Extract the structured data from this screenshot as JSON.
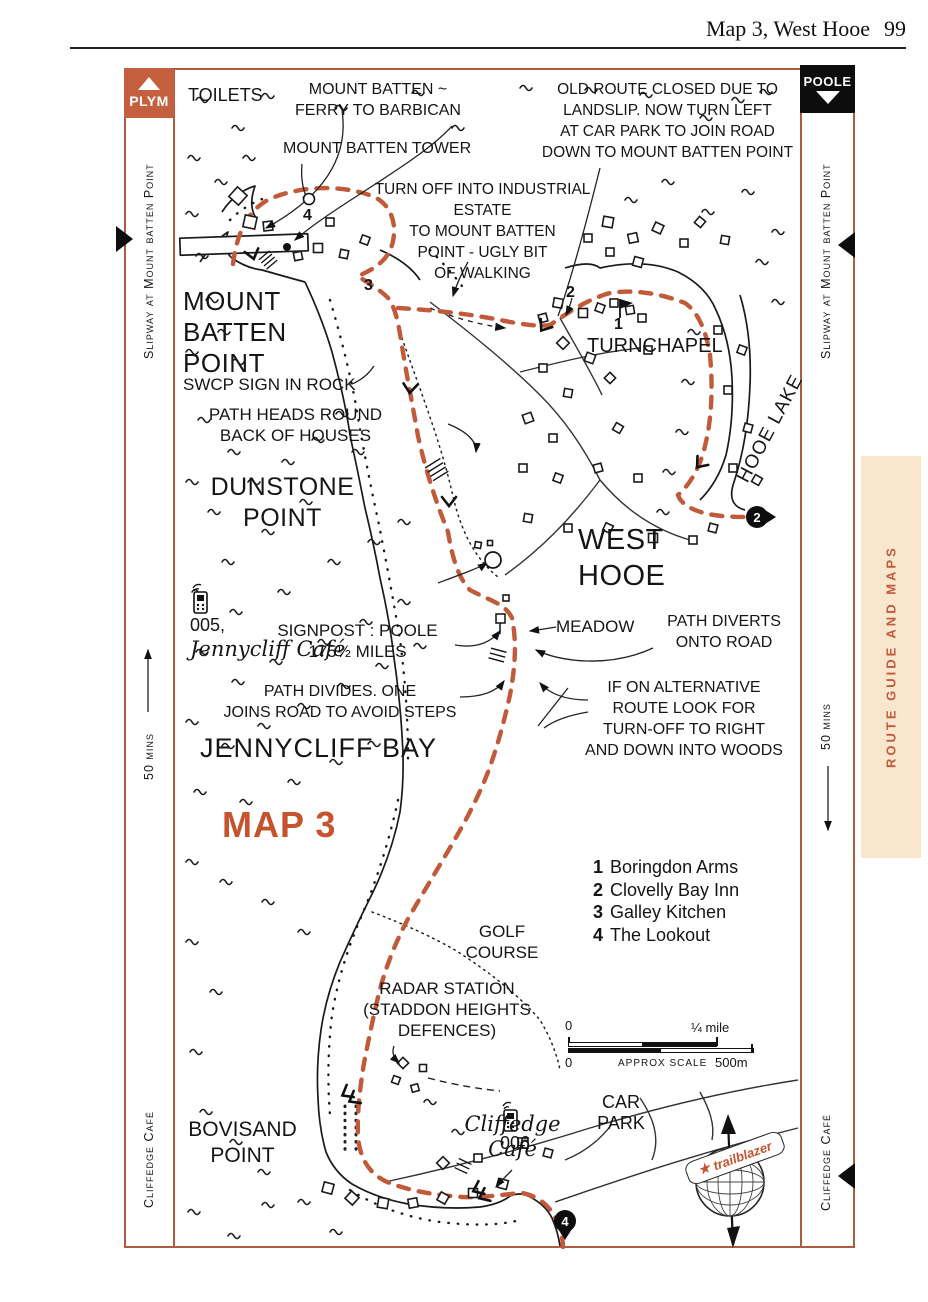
{
  "page": {
    "header_title": "Map 3, West Hooe",
    "page_number": "99"
  },
  "corner_tabs": {
    "plym": "PLYM",
    "poole": "POOLE"
  },
  "margins": {
    "left": {
      "top_label": "Slipway at Mount batten Point",
      "mid_label": "50 mins",
      "bottom_label": "Cliffedge Café"
    },
    "right": {
      "top_label": "Slipway at Mount batten Point",
      "mid_label": "50 mins",
      "bottom_label": "Cliffedge Café",
      "tab_label": "ROUTE GUIDE AND MAPS"
    }
  },
  "map": {
    "title": "MAP 3",
    "labels": {
      "toilets": "TOILETS",
      "ferry": "MOUNT BATTEN ~\nFERRY TO BARBICAN",
      "tower": "MOUNT BATTEN TOWER",
      "old_route": "OLD ROUTE CLOSED DUE TO\nLANDSLIP. NOW TURN LEFT\nAT CAR PARK TO JOIN ROAD\nDOWN TO MOUNT BATTEN POINT",
      "turn_off": "TURN OFF INTO INDUSTRIAL ESTATE\nTO MOUNT BATTEN\nPOINT - UGLY BIT\nOF WALKING",
      "mount_batten_point": "MOUNT\nBATTEN\nPOINT",
      "swcp": "SWCP SIGN IN ROCK",
      "path_heads": "PATH HEADS ROUND\nBACK OF HOUSES",
      "turnchapel": "TURNCHAPEL",
      "hooe_lake": "HOOE LAKE",
      "dunstone": "DUNSTONE\nPOINT",
      "jennycliff_cafe_num": "005,",
      "jennycliff_cafe_name": "Jennycliff Café",
      "west_hooe": "WEST\nHOOE",
      "signpost": "SIGNPOST : POOLE\n175½ MILES",
      "meadow": "MEADOW",
      "path_diverts": "PATH DIVERTS\nONTO ROAD",
      "path_divides": "PATH DIVIDES. ONE\nJOINS ROAD TO AVOID STEPS",
      "alternative": "IF ON ALTERNATIVE\nROUTE LOOK FOR\nTURN-OFF TO RIGHT\nAND DOWN INTO WOODS",
      "jennycliff_bay": "JENNYCLIFF BAY",
      "golf": "GOLF\nCOURSE",
      "radar": "RADAR STATION\n(STADDON HEIGHTS\nDEFENCES)",
      "cliffedge_cafe_num": "006",
      "cliffedge_cafe_name": "Cliffedge\nCafé",
      "car_park": "CAR\nPARK",
      "bovisand": "BOVISAND\nPOINT"
    }
  },
  "legend": {
    "items": [
      {
        "num": "1",
        "name": "Boringdon Arms"
      },
      {
        "num": "2",
        "name": "Clovelly Bay Inn"
      },
      {
        "num": "3",
        "name": "Galley Kitchen"
      },
      {
        "num": "4",
        "name": "The Lookout"
      }
    ]
  },
  "scale": {
    "top_zero": "0",
    "top_right": "¼ mile",
    "bottom_zero": "0",
    "caption": "APPROX SCALE",
    "bottom_right": "500m"
  },
  "waypoints": {
    "pin_2": "2",
    "pin_4": "4",
    "num_1": "1",
    "num_2": "2",
    "num_3": "3",
    "num_4": "4"
  },
  "compass": {
    "star": "★",
    "banner": "trailblazer"
  },
  "colors": {
    "accent": "#c4532e",
    "route": "#c05a38",
    "frame": "#b05a40",
    "tab_bg": "#f9e6cf"
  }
}
